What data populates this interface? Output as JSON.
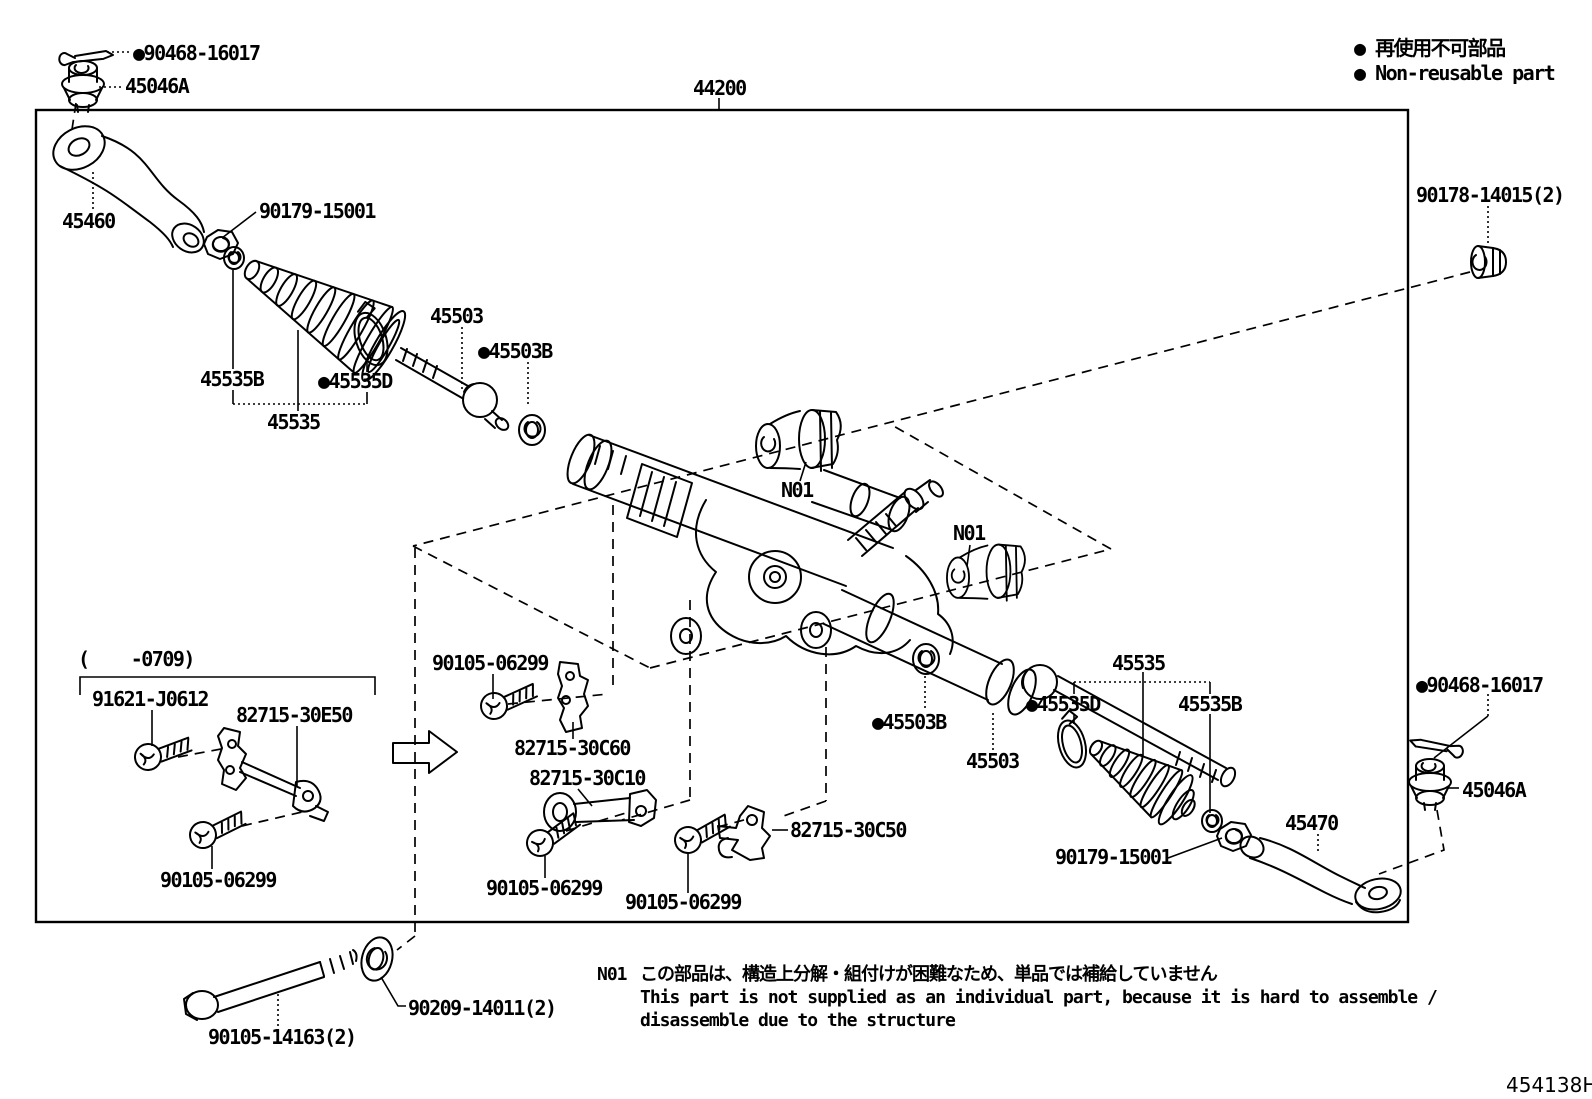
{
  "title_part_number": "44200",
  "legend": {
    "non_reusable_jp": "● 再使用不可部品",
    "non_reusable_en": "● Non-reusable part"
  },
  "note": {
    "code": "N01",
    "line_jp": "この部品は、構造上分解・組付けが困難なため、単品では補給していません",
    "line_en_1": "This part is not supplied as an individual part, because it is hard to assemble /",
    "line_en_2": "disassemble due to the structure"
  },
  "diagram_code": "454138H",
  "callouts": {
    "c90468_top": "●90468-16017",
    "c45046a_top": "45046A",
    "c90178": "90178-14015(2)",
    "c45460": "45460",
    "c90179_left": "90179-15001",
    "c45503_left": "45503",
    "c45503b_left": "●45503B",
    "c45535b_left": "45535B",
    "c45535d_left": "●45535D",
    "c45535_left": "45535",
    "n01_top": "N01",
    "n01_right": "N01",
    "c0709": "(    -0709)",
    "c91621": "91621-J0612",
    "c82715_30e50": "82715-30E50",
    "c90105_left": "90105-06299",
    "c90105_mid_top": "90105-06299",
    "c82715_30c60": "82715-30C60",
    "c82715_30c10": "82715-30C10",
    "c90105_mid_bottom": "90105-06299",
    "c90105_bottom_right": "90105-06299",
    "c82715_30c50": "82715-30C50",
    "c45503b_right": "●45503B",
    "c45535_right": "45535",
    "c45535d_right": "●45535D",
    "c45535b_right": "45535B",
    "c45503_right": "45503",
    "c90179_right": "90179-15001",
    "c45470": "45470",
    "c90468_right": "●90468-16017",
    "c45046a_right": "45046A",
    "c90105_14163": "90105-14163(2)",
    "c90209_14011": "90209-14011(2)"
  }
}
